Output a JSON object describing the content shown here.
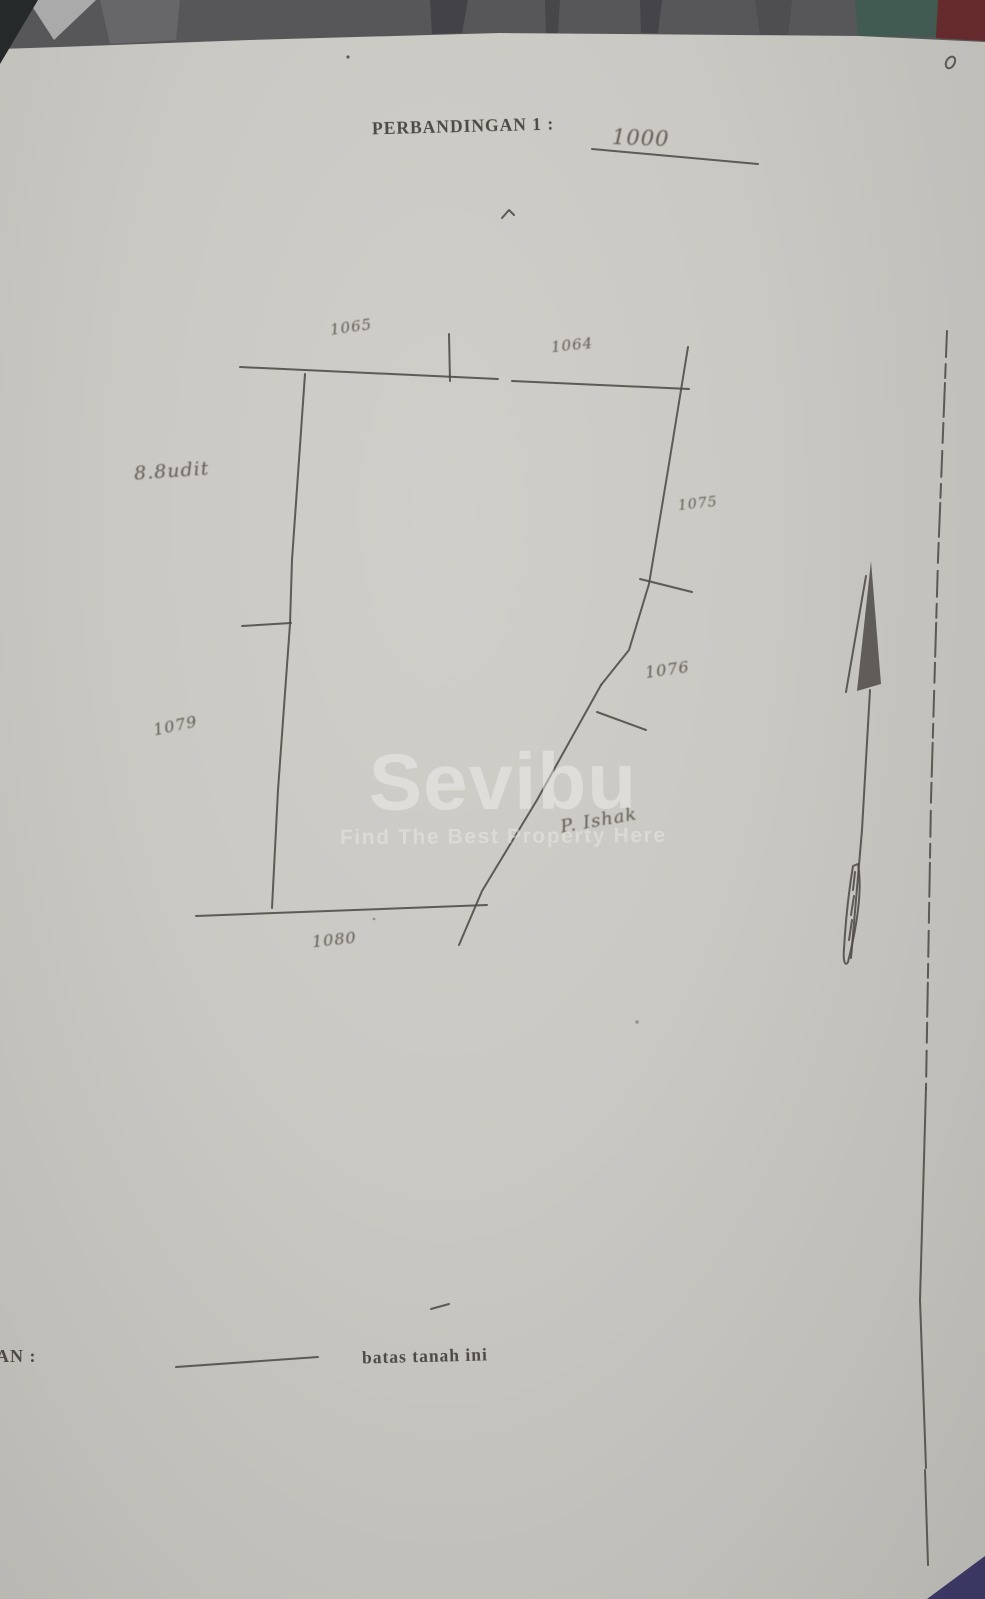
{
  "colors": {
    "paper": "#c8c6c1",
    "ink": "#4e4a45",
    "handwriting": "#5f5b52",
    "watermark-color": "rgba(240,240,237,0.48)",
    "top-band": "#57575a",
    "teal-patch": "#415a52",
    "red-corner": "#652a2b",
    "navy-corner": "#3a3763",
    "dark-corner": "#26292a"
  },
  "header": {
    "scale_label": "PERBANDINGAN 1 :",
    "scale_value": "1000"
  },
  "sketch": {
    "labels": {
      "top_left": "1065",
      "top_right": "1064",
      "left_upper": "8.8udit",
      "left_lower": "1079",
      "right_upper": "1075",
      "right_middle": "1076",
      "owner": "P. Ishak",
      "bottom": "1080"
    },
    "north_arrow_icon": "north-arrow"
  },
  "watermark": {
    "brand": "Sevibu",
    "tagline": "Find The Best Property Here"
  },
  "legend": {
    "label_prefix": "AN :",
    "boundary_label": "batas tanah ini"
  }
}
